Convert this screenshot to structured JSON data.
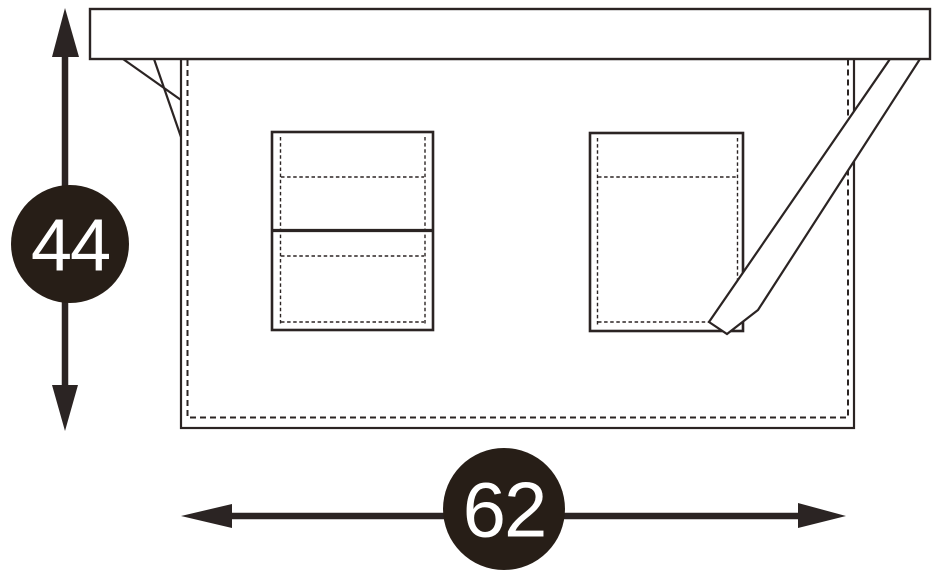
{
  "dimensions": {
    "height": {
      "value": "44"
    },
    "width": {
      "value": "62"
    }
  },
  "colors": {
    "ink": "#2b2423",
    "badge": "#271e17",
    "paper": "#ffffff",
    "label": "#ffffff"
  }
}
